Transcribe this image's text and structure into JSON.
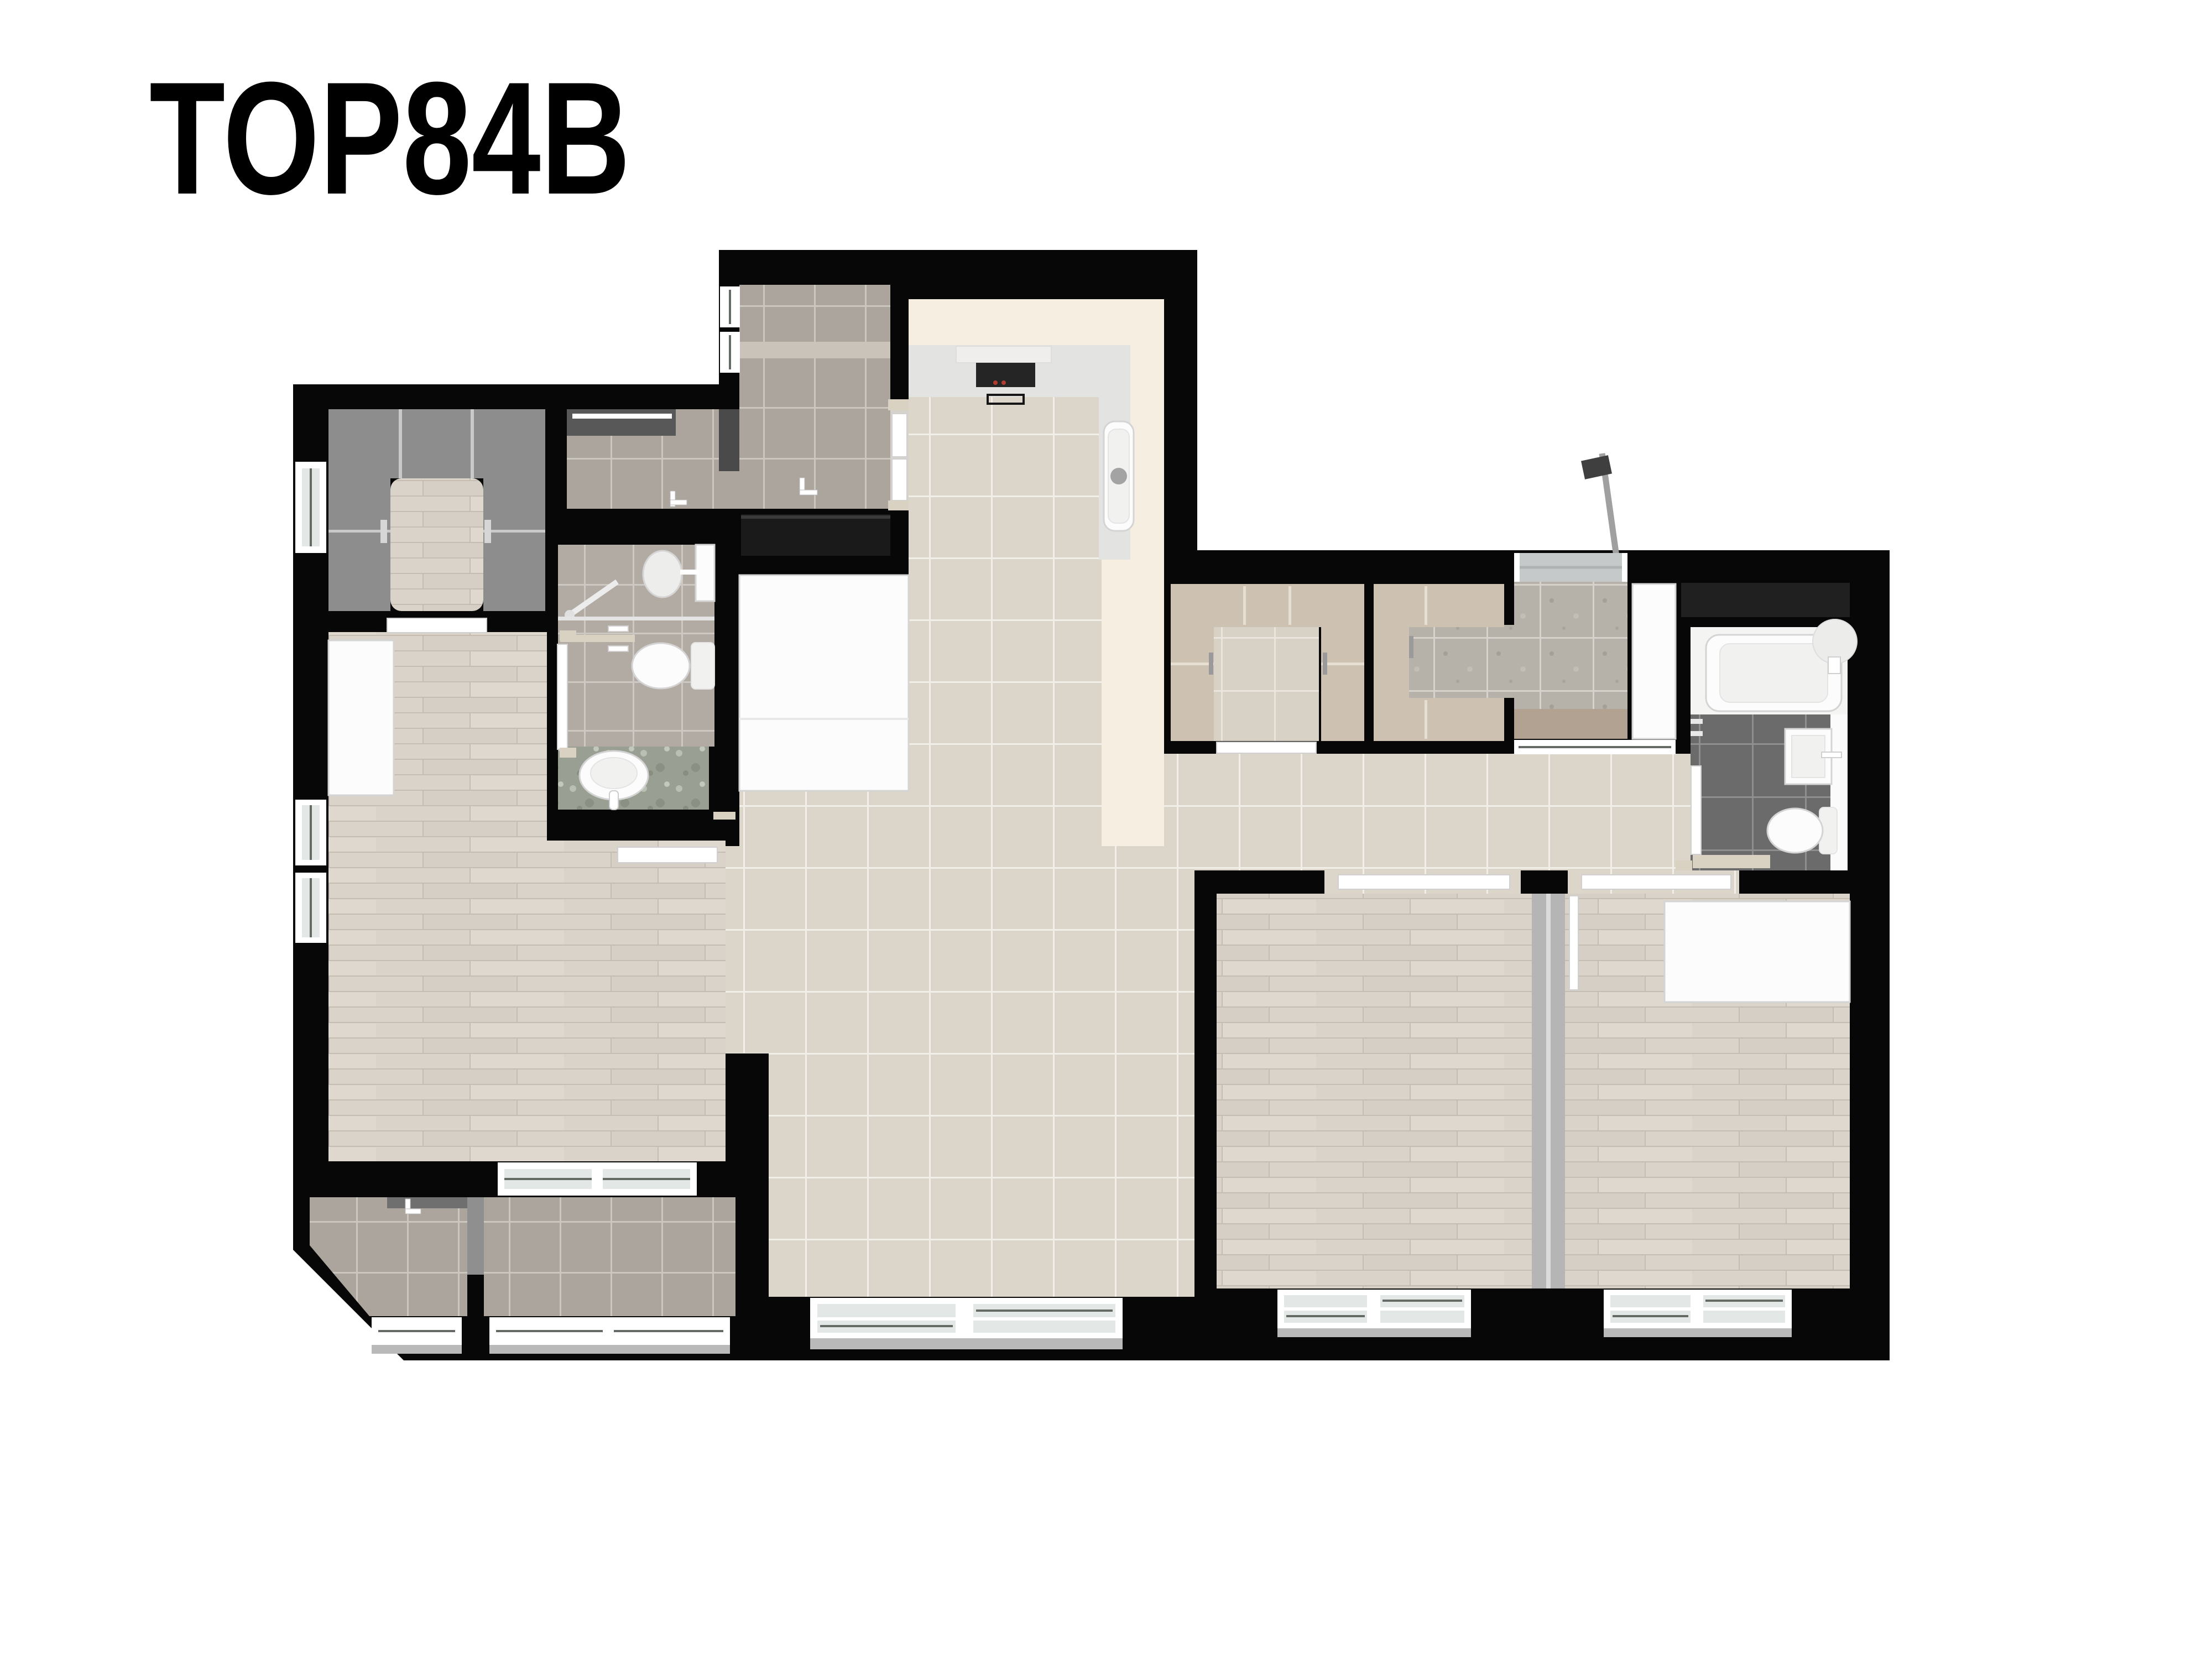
{
  "title": "TOP84B",
  "palette": {
    "wall": "#070707",
    "exterior": "#ffffff",
    "cream": "#f6efe1",
    "counter": "#e3e3e1",
    "hood": "#efeeec",
    "cooktop": "#252525",
    "burnerRed": "#b23c30",
    "tileBeige": "#dcd5c9",
    "groutBeige": "#f2efe8",
    "tileGray": "#aba59d",
    "groutGray": "#cbc6be",
    "tileBath": "#b2aba3",
    "groutBath": "#cdc8c1",
    "tileDark": "#6b6b6b",
    "groutDark": "#8f8f8f",
    "tilePantry": "#d8d1c6",
    "groutPantry": "#eae5dc",
    "speckle": "#b6b1a9",
    "groutSpeckle": "#d7d3cc",
    "terrazzo": "#99a093",
    "wood": "#d9d3c9",
    "woodLine": "#c5bdb1",
    "wardrobe": "#8d8d8d",
    "wardrobeLine": "#c9c9c9",
    "cabinetBeige": "#cdc2b1",
    "cabinetBeigeLine": "#e6ded0",
    "cabinetDark": "#1a1a1a",
    "fixWhite": "#fcfcfc",
    "fixStroke": "#d4d4d4",
    "fixInner": "#f1f1f0",
    "windowGlass": "#e3e7e6",
    "windowLine": "#646b64",
    "sill": "#b9b9b9",
    "threshold": "#d9d1c1",
    "concrete": "#d6d3cd",
    "counterDark": "#585858",
    "partition": "#b5b5b5",
    "darkPartition": "#4a4a4a",
    "pole": "#a0a0a0",
    "brownMat": "#b2a291",
    "shelf": "#c9c3b9"
  }
}
